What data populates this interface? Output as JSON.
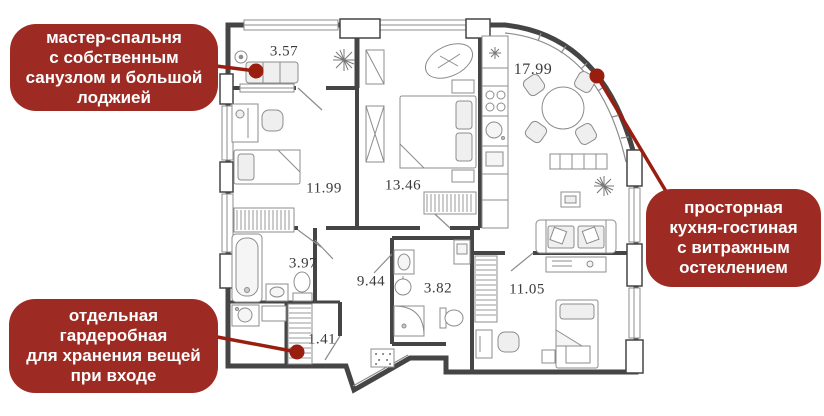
{
  "callouts": {
    "master": {
      "lines": [
        "мастер-спальня",
        "с собственным",
        "санузлом и большой",
        "лоджией"
      ]
    },
    "kitchen": {
      "lines": [
        "просторная",
        "кухня-гостиная",
        "с витражным",
        "остеклением"
      ]
    },
    "wardrobe": {
      "lines": [
        "отдельная",
        "гардеробная",
        "для хранения вещей",
        "при входе"
      ]
    }
  },
  "rooms": {
    "loggia": "3.57",
    "kitchen_living": "17.99",
    "bedroom_left": "11.99",
    "master_bedroom": "13.46",
    "bathroom_main": "3.97",
    "hallway": "9.44",
    "bathroom_guest": "3.82",
    "bedroom_right": "11.05",
    "entry_wardrobe": "1.41"
  },
  "colors": {
    "callout_bg": "#9e2b23",
    "connector": "#991e0f",
    "wall": "#454545",
    "text": "#ffffff"
  }
}
